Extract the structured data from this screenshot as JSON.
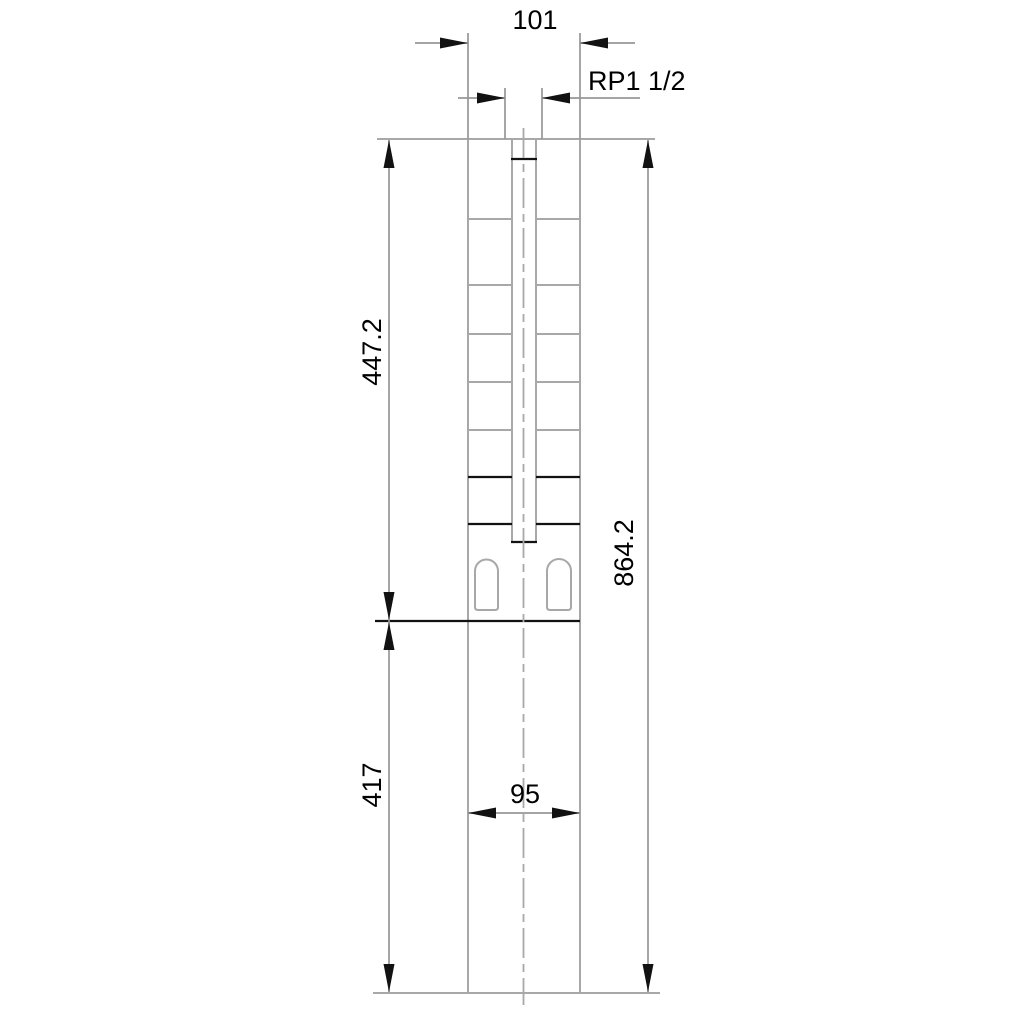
{
  "drawing": {
    "labels": {
      "top_width": "101",
      "thread_connection": "RP1 1/2",
      "upper_section_height": "447.2",
      "overall_height": "864.2",
      "lower_section_height": "417",
      "lower_body_width": "95"
    },
    "colors": {
      "background": "#ffffff",
      "body_gray": "#a8a8a8",
      "dim_gray": "#979797",
      "black": "#121212"
    }
  }
}
